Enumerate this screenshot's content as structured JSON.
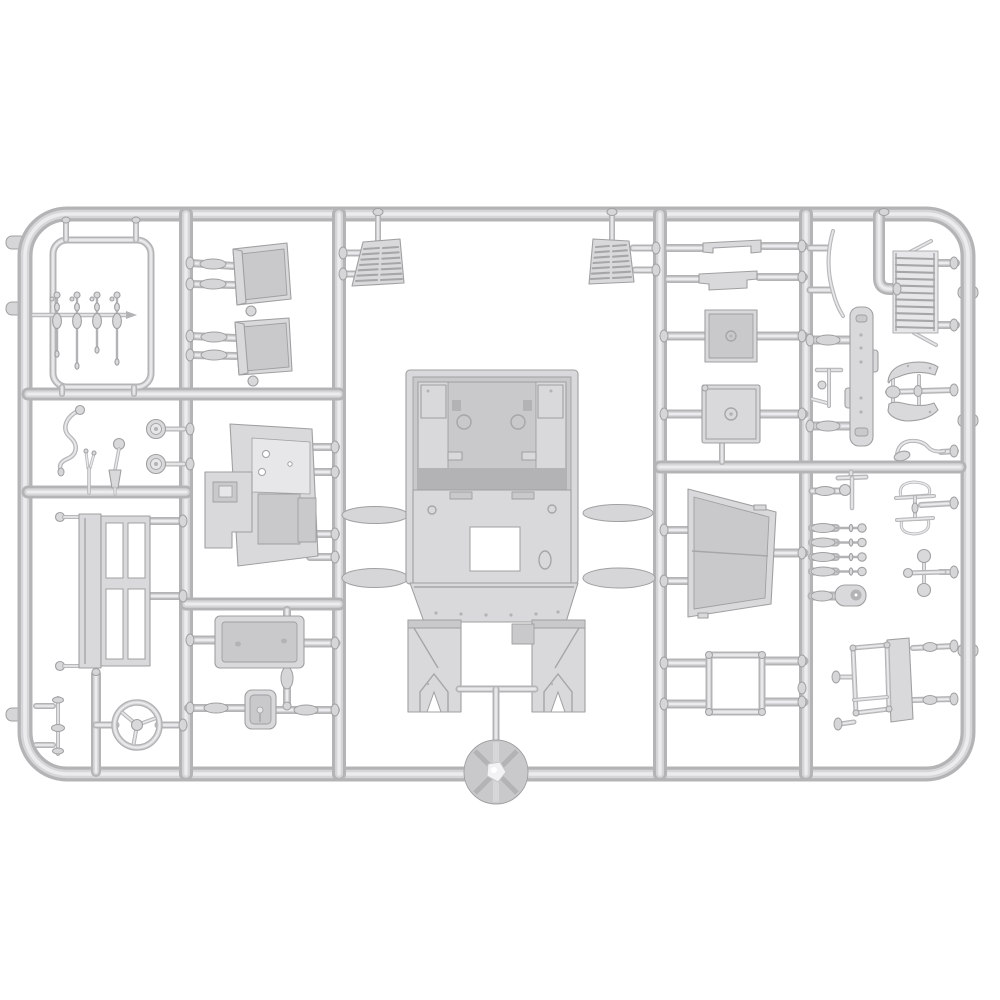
{
  "image": {
    "width": 1000,
    "height": 1000,
    "kind": "product photograph",
    "subject": "plastic model kit sprue"
  },
  "scene": {
    "description": "Light gray injection-molded polystyrene sprue (parts tree) for a truck model kit, photographed on a plain white background. A rounded rectangular outer runner frame with four internal vertical runners holds many small molded parts connected by short gates.",
    "background": "plain white",
    "material": "light gray polystyrene"
  },
  "palette": {
    "background": "#ffffff",
    "plastic_edge": "#b4b4b6",
    "plastic_mid": "#d6d6d8",
    "plastic_highlight": "#ececee",
    "part_fill": "#d9d9db",
    "part_shadow": "#c9c9cb",
    "part_deep_shadow": "#b3b3b5",
    "part_light": "#e7e7e9",
    "outline": "#a0a0a2",
    "detail_line": "#a6a6a8"
  },
  "parts": {
    "control_lever_set": {
      "label": "Set of four small control levers on a feed rod inside a thin sub-frame",
      "count": 4
    },
    "seat_upper": {
      "label": "Bucket seat shell, upper"
    },
    "seat_lower": {
      "label": "Bucket seat shell, lower"
    },
    "vent_left": {
      "label": "Louvered vent panel, left of center"
    },
    "vent_right": {
      "label": "Louvered vent panel, right of center"
    },
    "dashboard": {
      "label": "Dashboard / firewall bulkhead with instrument holes"
    },
    "tray": {
      "label": "Open rectangular stowage tray"
    },
    "latch_box": {
      "label": "Small open box with center pin"
    },
    "window_frame": {
      "label": "Window frame with four panes"
    },
    "steering_wheel": {
      "label": "Three-spoke steering wheel"
    },
    "axle_rod": {
      "label": "Short rod with collar discs"
    },
    "crank_handle": {
      "label": "S-shaped starting crank handle"
    },
    "dial_upper": {
      "label": "Round dial / horn part, upper"
    },
    "dial_lower": {
      "label": "Round dial / horn part, lower"
    },
    "gear_lever": {
      "label": "Gear lever with ball knob"
    },
    "clutch_fork": {
      "label": "Small forked lever"
    },
    "cab_body": {
      "label": "Large cab body shell with footwell legs"
    },
    "sprue_hub": {
      "label": "Round injection hub on bottom runner"
    },
    "bracket_upper": {
      "label": "Stepped strip bracket, upper"
    },
    "bracket_lower": {
      "label": "Stepped strip bracket, lower"
    },
    "panel_upper": {
      "label": "Square hatch panel, upper"
    },
    "panel_lower": {
      "label": "Square hatch panel with rim, lower"
    },
    "windshield": {
      "label": "Windshield frame panel in perspective"
    },
    "square_frame": {
      "label": "Open square window frame"
    },
    "wiper_blade": {
      "label": "Curved thin blade part"
    },
    "radiator_grille": {
      "label": "Slatted radiator grille"
    },
    "chassis_rail": {
      "label": "Vertical chassis rail plate with rivets"
    },
    "t_lever": {
      "label": "Small T-shaped rod with ball"
    },
    "t_handle": {
      "label": "T-handle with ball joint"
    },
    "tie_rods": {
      "label": "Row of four bolt-shaped tie rods",
      "count": 4
    },
    "shackle": {
      "label": "Clevis shackle with hole"
    },
    "bench_frame": {
      "label": "Bench / stretcher frame with side plank"
    },
    "fender_pair": {
      "label": "Pair of curved fenders on an axle rod",
      "count": 2
    },
    "hook_lever": {
      "label": "Curved hook lever with paddle end"
    },
    "mirror_bracket": {
      "label": "Double loop mirror bracket"
    },
    "knob_cross": {
      "label": "Cross-shaped part with two ball knobs"
    }
  },
  "generated": {
    "levers": {
      "count": 4,
      "cx0": 57,
      "dx": 20,
      "rod_y": 315,
      "stem_lengths": [
        56,
        68,
        52,
        64
      ]
    },
    "vent_louvers": {
      "left": {
        "count": 7,
        "x_left_top": 364,
        "x_right_top": 398,
        "y_top": 248,
        "x_left_bot": 356,
        "x_right_bot": 402,
        "y_bot": 280
      },
      "right": {
        "count": 7,
        "x_left_top": 596,
        "x_right_top": 626,
        "y_top": 246,
        "x_left_bot": 591,
        "x_right_bot": 631,
        "y_bot": 278
      }
    },
    "grille_slats": {
      "count": 11,
      "x1": 896,
      "x2": 934,
      "y0": 258,
      "dy": 6.9
    },
    "tie_rods": {
      "count": 4,
      "y0": 528,
      "dy": 14.5
    }
  }
}
